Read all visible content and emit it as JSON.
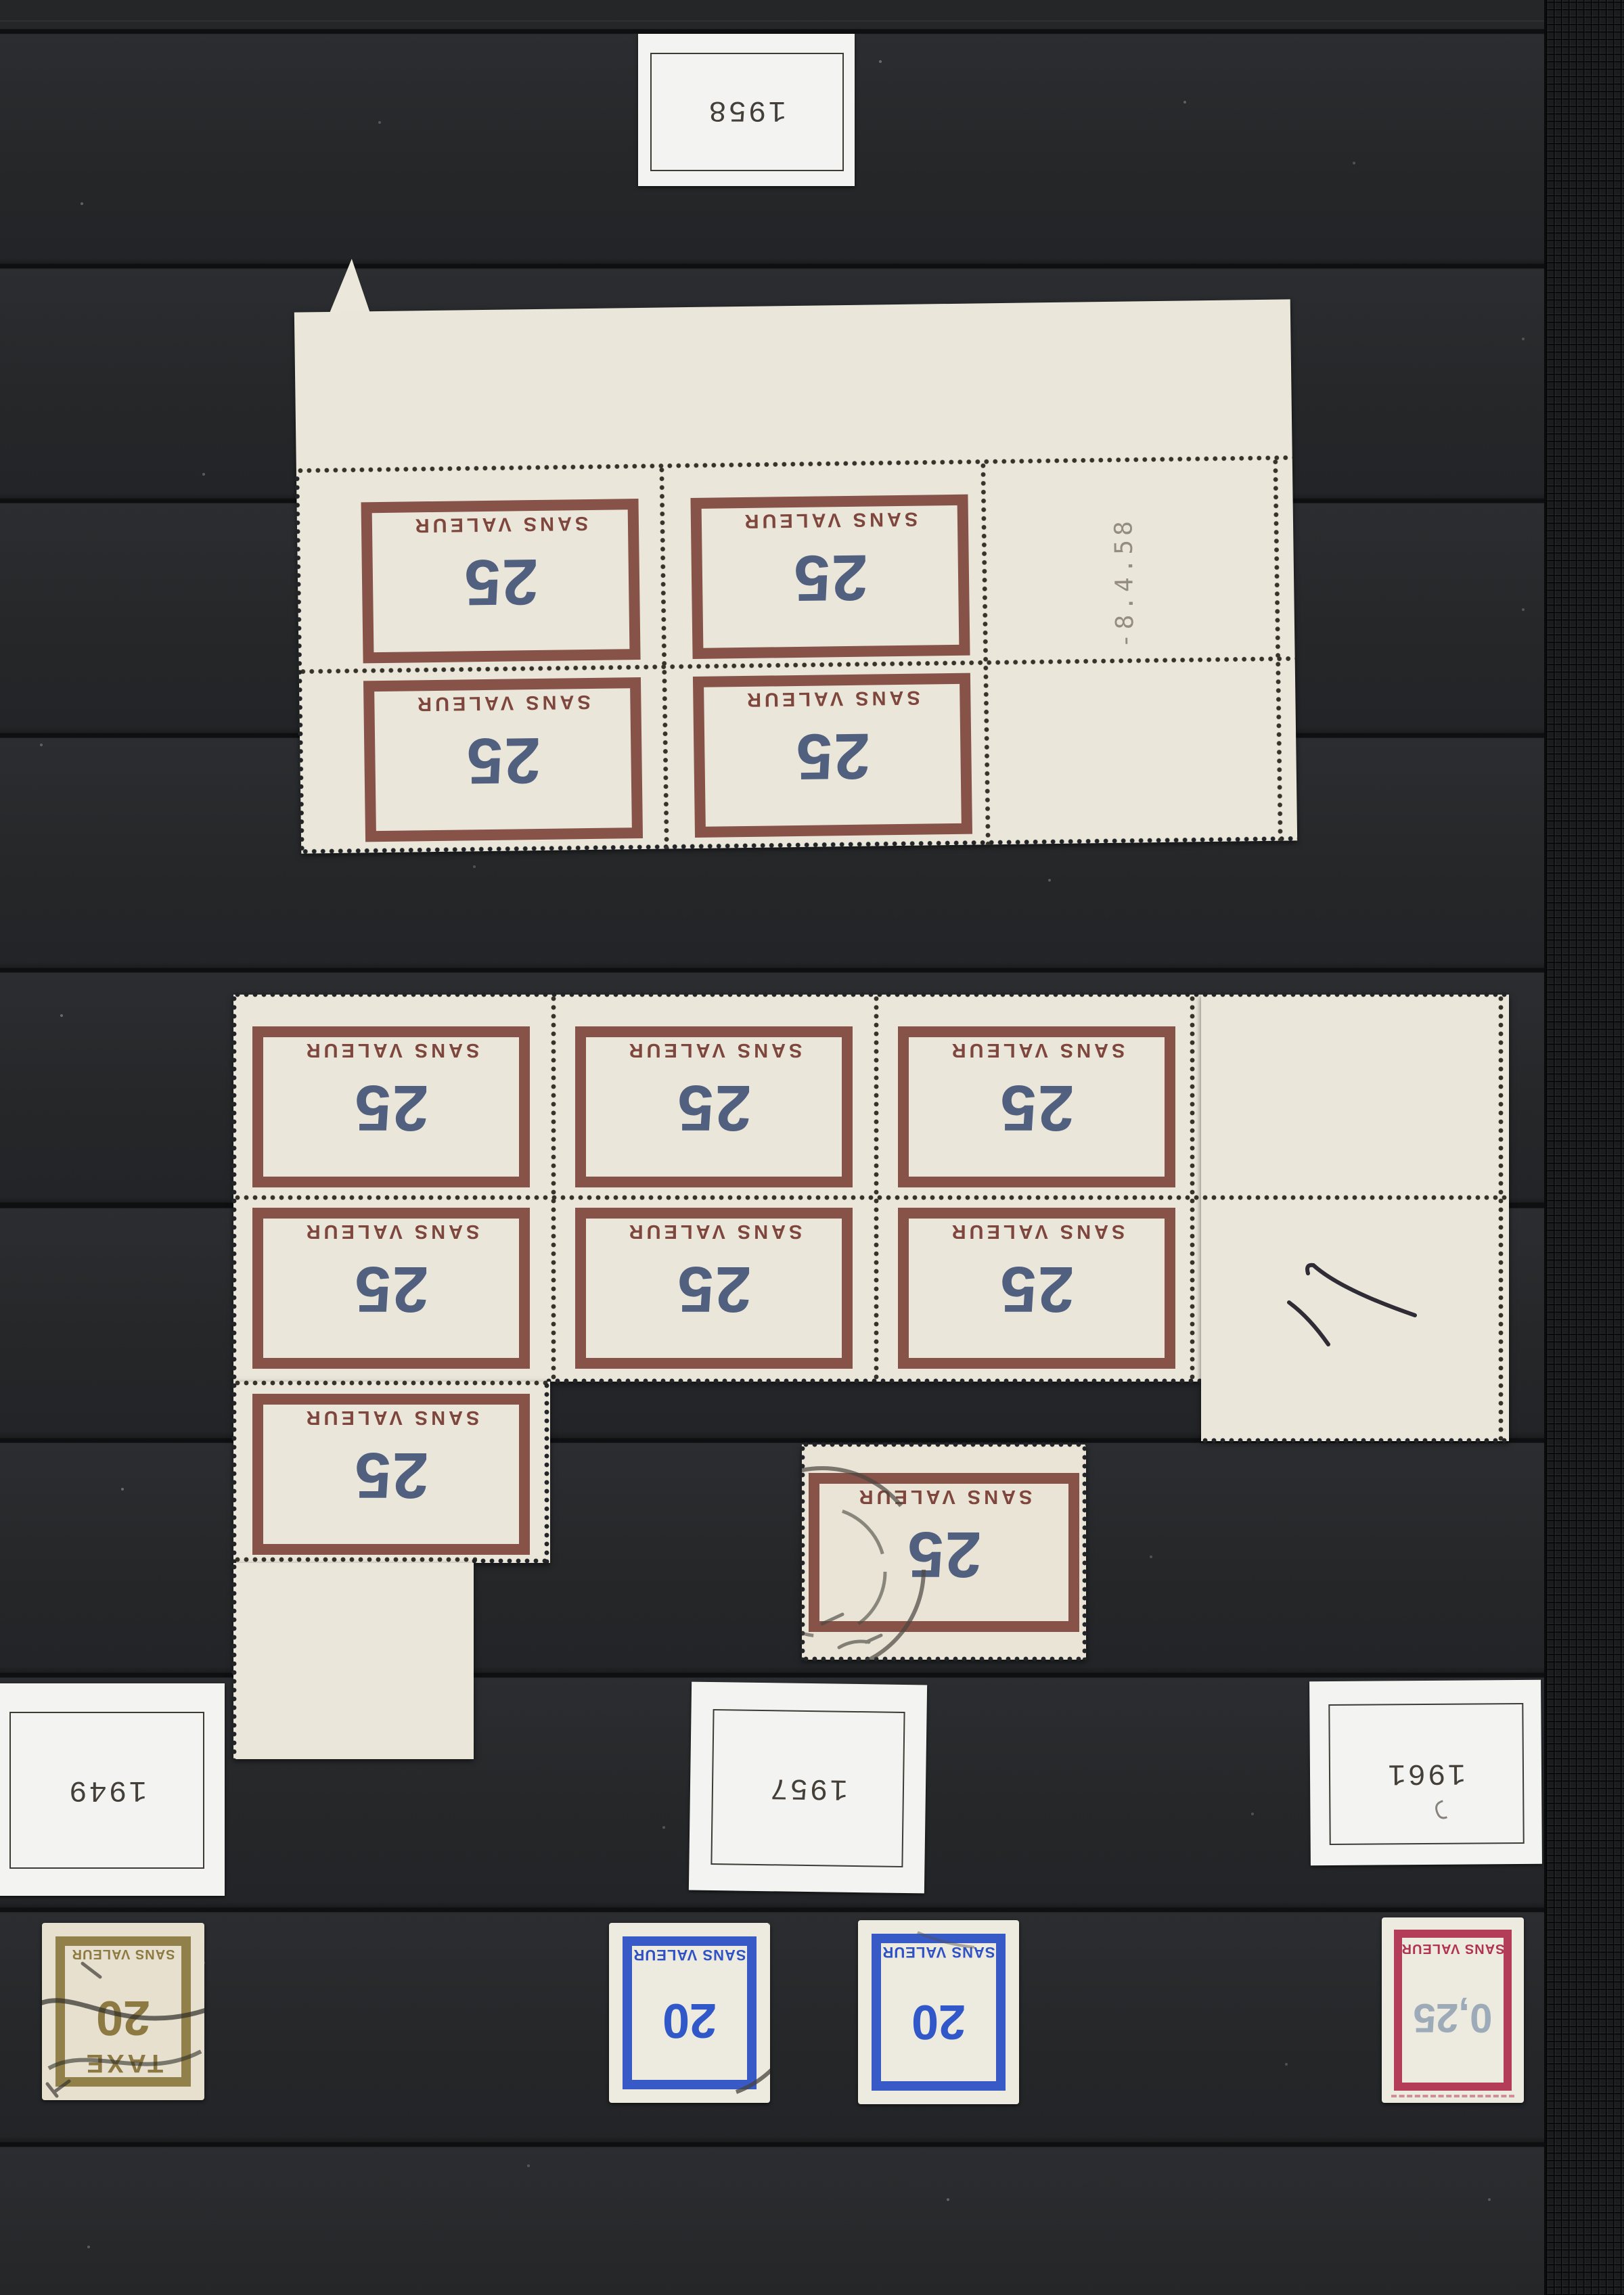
{
  "album": {
    "year_labels": {
      "top": "1958",
      "bottom_left": "1949",
      "bottom_middle": "1957",
      "bottom_right": "1961"
    },
    "sheet_corner_date": "-8.4.58",
    "stamps": {
      "sans_valeur": "SANS VALEUR",
      "value_25": "25",
      "value_20": "20",
      "value_0_25": "0,25",
      "taxe": "TAXE"
    },
    "postmark_fragment": "CTION",
    "pieces": {
      "top_corner_block_count": 4,
      "middle_block_count": 7,
      "single_used_count": 1,
      "bottom_row_count": 4
    },
    "colors": {
      "maroon_frame": "#7e463c",
      "value_blue_gray": "#51607e",
      "bistre": "#8c7a42",
      "blue": "#2e52c4",
      "carmine": "#b03350",
      "sheet_cream": "#eae6da",
      "label_white": "#f3f4f2",
      "page_black": "#242628"
    }
  }
}
